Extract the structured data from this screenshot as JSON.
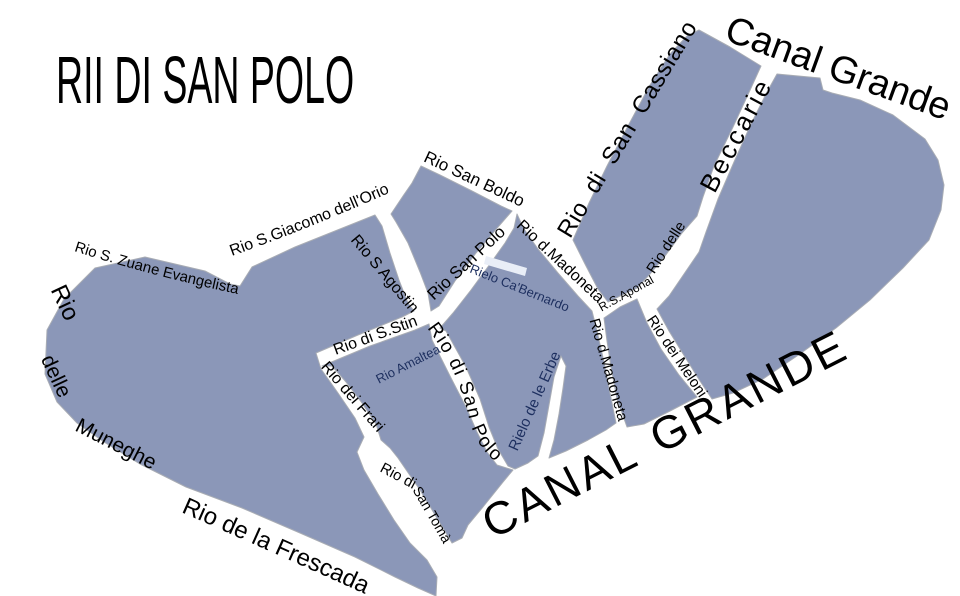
{
  "title": "RII DI SAN POLO",
  "map": {
    "land_color": "#8b97b8",
    "land_stroke": "#a8acb4",
    "water_color": "#ffffff",
    "label_color": "#000000",
    "filled_canal_label_color": "#1d2f5f",
    "rielo_stripe": {
      "color": "#e9eef7",
      "points": "486,256 527,268 525,276 484,264"
    },
    "islands": [
      {
        "name": "frari-frescada",
        "points": "95,268 145,257 205,271 230,284 240,286 252,267 295,247 340,229 375,215 382,226 390,253 399,280 408,303 414,311 402,317 358,335 316,353 321,369 338,393 355,418 364,437 357,452 364,470 378,494 394,520 410,543 427,560 437,577 436,596 418,588 395,577 355,557 300,533 242,508 186,487 140,464 104,442 77,423 57,402 45,374 47,330 64,299"
      },
      {
        "name": "amaltea-san-toma",
        "points": "322,366 370,346 415,330 429,324 432,340 450,376 466,407 477,432 487,452 497,465 513,470 503,482 483,507 468,525 462,538 452,543 440,523 420,490 398,458 390,448 381,440 376,424 362,403 346,382 332,366"
      },
      {
        "name": "san-boldo",
        "points": "421,166 440,175 472,191 501,206 512,211 498,227 476,253 455,281 439,306 431,311 428,293 420,272 408,243 396,222 391,214 403,196 412,183"
      },
      {
        "name": "ca-bernardo",
        "points": "517,214 524,229 538,249 558,273 578,296 592,311 597,331 604,362 610,393 616,423 606,430 588,440 566,451 549,458 554,440 559,414 563,388 566,366 561,356 554,377 549,405 544,433 538,456 528,463 515,469 508,466 498,449 489,427 480,399 466,367 446,331 440,328 453,313 471,290 490,264 505,243 514,228"
      },
      {
        "name": "madoneta-meloni",
        "points": "604,318 620,307 637,299 647,323 661,349 679,375 697,397 670,411 644,424 627,427 617,399 611,367 607,341"
      },
      {
        "name": "san-cassiano-beccarie",
        "points": "699,30 730,47 761,66 751,88 733,127 714,166 703,197 697,216 682,233 665,256 650,274 637,288 620,296 608,302 598,289 585,264 573,240 589,203 607,166 628,126 650,85 670,54 687,36"
      },
      {
        "name": "rialto-east",
        "points": "777,74 820,78 823,90 832,93 860,100 893,115 925,139 938,160 944,185 941,210 929,240 903,268 870,300 836,328 797,356 763,379 733,393 712,399 700,381 685,357 669,331 657,309 669,296 684,274 699,252 706,232 718,199 734,162 751,124 767,92"
      }
    ],
    "labels": [
      {
        "name": "label-canal-grande-upper",
        "text": "Canal Grande",
        "x": 834,
        "y": 80,
        "rotate": 20,
        "size": 38,
        "ls": 0
      },
      {
        "name": "label-canal-grande-lower",
        "text": "CANAL GRANDE",
        "x": 672,
        "y": 448,
        "rotate": -27,
        "size": 46,
        "ls": 3,
        "ws": 6
      },
      {
        "name": "label-rio-di-san-cassiano",
        "text": "Rio di San Cassiano",
        "x": 634,
        "y": 133,
        "rotate": -59,
        "size": 24,
        "ls": 0.5,
        "ws": 7
      },
      {
        "name": "label-beccarie",
        "text": "Beccarie",
        "x": 744,
        "y": 139,
        "rotate": -62,
        "size": 26,
        "ls": 3
      },
      {
        "name": "label-rio-delle",
        "text": "Rio delle",
        "x": 670,
        "y": 250,
        "rotate": -57,
        "size": 15
      },
      {
        "name": "label-rs-aponal",
        "text": "R.S.Aponal",
        "x": 628,
        "y": 297,
        "rotate": -29,
        "size": 12
      },
      {
        "name": "label-rio-san-boldo",
        "text": "Rio San Boldo",
        "x": 472,
        "y": 184,
        "rotate": 25,
        "size": 17
      },
      {
        "name": "label-muneghe-rio",
        "text": "Rio",
        "x": 58,
        "y": 306,
        "rotate": 65,
        "size": 24
      },
      {
        "name": "label-muneghe-delle",
        "text": "delle",
        "x": 50,
        "y": 379,
        "rotate": 65,
        "size": 21
      },
      {
        "name": "label-muneghe-muneghe",
        "text": "Muneghe",
        "x": 113,
        "y": 450,
        "rotate": 27,
        "size": 21
      },
      {
        "name": "label-rio-di-san-toma-1",
        "text": "Rio di",
        "x": 396,
        "y": 480,
        "rotate": 28,
        "size": 15
      },
      {
        "name": "label-rio-di-san-toma-2",
        "text": "San Tomà",
        "x": 428,
        "y": 517,
        "rotate": 60,
        "size": 14
      },
      {
        "name": "label-rio-dei-frari",
        "text": "Rio dei Frari",
        "x": 349,
        "y": 400,
        "rotate": 49,
        "size": 16
      },
      {
        "name": "label-rio-di-s-stin",
        "text": "Rio di S.Stin",
        "x": 377,
        "y": 340,
        "rotate": -20,
        "size": 16
      },
      {
        "name": "label-rio-s-agostin",
        "text": "Rio S Agostin",
        "x": 381,
        "y": 277,
        "rotate": 50,
        "size": 16
      },
      {
        "name": "label-rio-san-polo-upper",
        "text": "Rio San Polo",
        "x": 470,
        "y": 267,
        "rotate": -43,
        "size": 17
      },
      {
        "name": "label-rio-d-madoneta-upper",
        "text": "Rio d.Madoneta",
        "x": 557,
        "y": 265,
        "rotate": 43,
        "size": 16
      },
      {
        "name": "label-rio-d-madoneta-lower",
        "text": "Rio d.Madoneta",
        "x": 604,
        "y": 371,
        "rotate": 74,
        "size": 15
      },
      {
        "name": "label-rio-dei-meloni",
        "text": "Rio dei Meloni",
        "x": 673,
        "y": 359,
        "rotate": 56,
        "size": 15
      },
      {
        "name": "label-rielo-de-le-erbe",
        "text": "Rielo de le Erbe",
        "x": 539,
        "y": 403,
        "rotate": -66,
        "size": 15,
        "color": "navy"
      },
      {
        "name": "label-rielo-ca-bernardo",
        "text": "Rielo Ca'Bernardo",
        "x": 518,
        "y": 292,
        "rotate": 22,
        "size": 13,
        "color": "navy"
      },
      {
        "name": "label-rio-amaltea",
        "text": "Rio Amaltea",
        "x": 410,
        "y": 368,
        "rotate": -27,
        "size": 13,
        "color": "navy"
      }
    ],
    "curved_labels": [
      {
        "name": "label-rio-s-giacomo-dellorio",
        "text": "Rio S.Giacomo dell'Orio",
        "path": "M 232,256 Q 316,226 409,184",
        "size": 16
      },
      {
        "name": "label-rio-s-zuane-evangelista",
        "text": "Rio S. Zuane Evangelista",
        "path": "M 74,251 Q 152,276 238,294",
        "size": 15
      },
      {
        "name": "label-rio-de-la-frescada",
        "text": "Rio de la Frescada",
        "path": "M 181,512 Q 272,552 374,598",
        "size": 24
      },
      {
        "name": "label-rio-di-san-polo-curved",
        "text": "Rio di San Polo",
        "path": "M 427,328 C 449,356 461,386 468,414 C 474,441 486,459 512,472",
        "size": 19,
        "ls": 1.5
      }
    ]
  }
}
